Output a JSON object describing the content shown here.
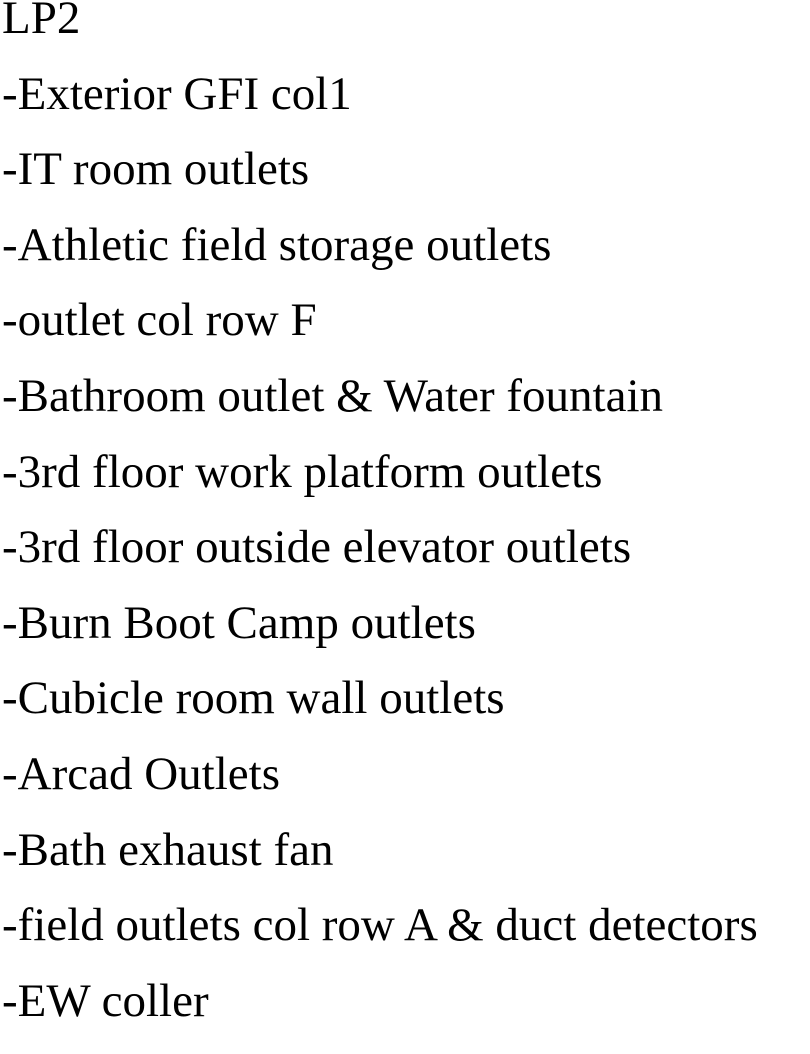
{
  "document": {
    "title": "LP2",
    "items": [
      "-Exterior GFI col1",
      "-IT room outlets",
      "-Athletic field storage outlets",
      "-outlet col row F",
      "-Bathroom outlet & Water fountain",
      "-3rd floor work platform outlets",
      "-3rd floor outside elevator outlets",
      "-Burn Boot Camp outlets",
      "-Cubicle room wall outlets",
      "-Arcad Outlets",
      "-Bath exhaust fan",
      "-field outlets col row A & duct detectors",
      "-EW coller"
    ],
    "text_color": "#000000",
    "background_color": "#ffffff"
  }
}
